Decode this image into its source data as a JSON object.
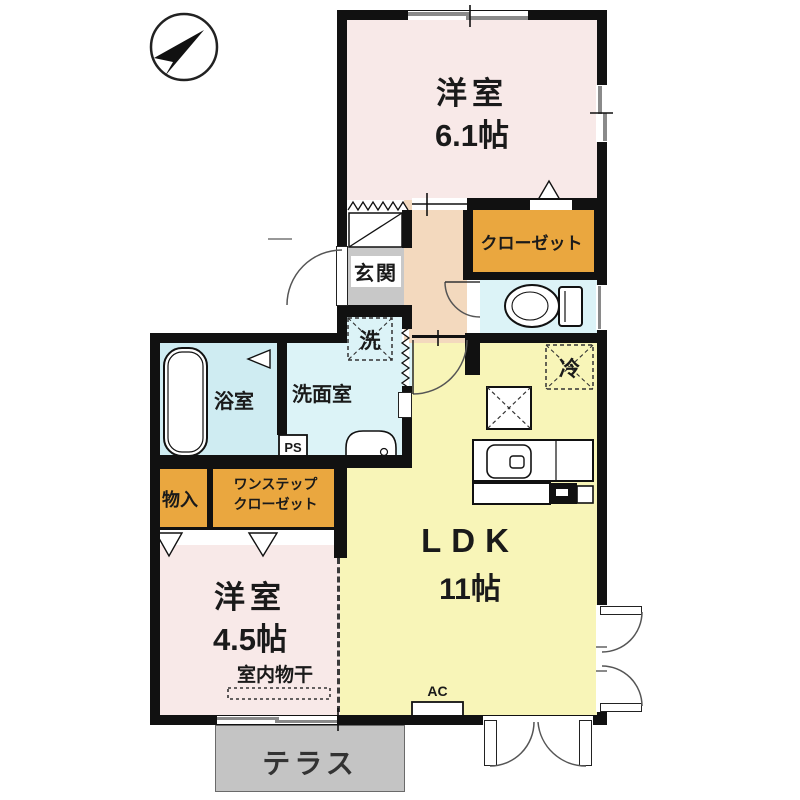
{
  "title": "1LDK floor plan",
  "colors": {
    "wall": "#111111",
    "room_pink": "#F8E9E8",
    "ldk_yellow": "#F8F5B8",
    "hall_peach": "#F3D9BE",
    "water_blue": "#DCF3F7",
    "bath_blue": "#CFECF2",
    "closet_orange": "#EAA73F",
    "genkan_gray": "#C8C8C8",
    "terrace_gray": "#C4C4C4"
  },
  "labels": {
    "bedroom1_name": "洋室",
    "bedroom1_size": "6.1帖",
    "bedroom2_name": "洋室",
    "bedroom2_size": "4.5帖",
    "ldk_name": "LDK",
    "ldk_size": "11帖",
    "closet": "クローゼット",
    "entrance": "玄関",
    "bath": "浴室",
    "washroom": "洗面室",
    "washer": "洗",
    "fridge": "冷",
    "ps": "PS",
    "ac": "AC",
    "storage": "物入",
    "onestep_line1": "ワンステップ",
    "onestep_line2": "クローゼット",
    "indoor_drying": "室内物干",
    "terrace": "テラス"
  }
}
